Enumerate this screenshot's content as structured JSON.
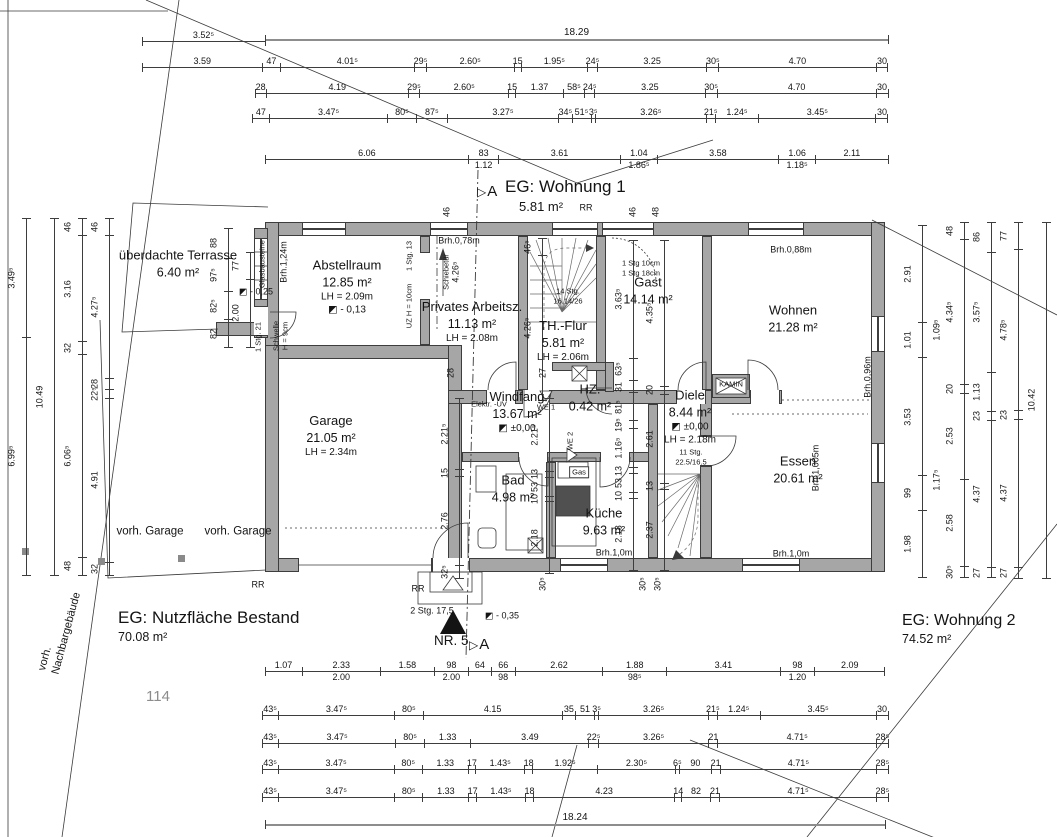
{
  "titles": {
    "wohnung1": "EG: Wohnung 1",
    "wohnung1_area": "5.81 m²",
    "wohnung2": "EG: Wohnung 2",
    "wohnung2_area": "74.52 m²",
    "bestand": "EG: Nutzfläche Bestand",
    "bestand_area": "70.08 m²",
    "parcel": "114",
    "neighbor1": "vorh.",
    "neighbor2": "Nachbargebäude",
    "house_no": "NR. 5",
    "section": "A"
  },
  "rooms": [
    {
      "name": "überdachte Terrasse",
      "lines": [
        "6.40 m²"
      ],
      "x": 178,
      "y": 264
    },
    {
      "name": "Abstellraum",
      "lines": [
        "12.85 m²",
        "LH = 2.09m",
        "◩ - 0,13"
      ],
      "x": 347,
      "y": 287
    },
    {
      "name": "Privates Arbeitsz.",
      "lines": [
        "11.13 m²",
        "LH = 2.08m"
      ],
      "x": 472,
      "y": 322
    },
    {
      "name": "TH.-Flur",
      "lines": [
        "5.81 m²",
        "LH = 2.06m"
      ],
      "x": 563,
      "y": 341
    },
    {
      "name": "Gast",
      "lines": [
        "14.14 m²"
      ],
      "x": 648,
      "y": 291
    },
    {
      "name": "Wohnen",
      "lines": [
        "21.28 m²"
      ],
      "x": 793,
      "y": 319
    },
    {
      "name": "Garage",
      "lines": [
        "21.05 m²",
        "LH = 2.34m"
      ],
      "x": 331,
      "y": 436
    },
    {
      "name": "Windfang",
      "lines": [
        "13.67 m²",
        "◩ ±0,00"
      ],
      "x": 517,
      "y": 412
    },
    {
      "name": "HZ.",
      "lines": [
        "0.42 m²"
      ],
      "x": 590,
      "y": 398
    },
    {
      "name": "Bad",
      "lines": [
        "4.98 m²"
      ],
      "x": 513,
      "y": 489
    },
    {
      "name": "Diele",
      "lines": [
        "8.44 m²",
        "◩ ±0,00",
        "LH = 2.18m"
      ],
      "x": 690,
      "y": 417
    },
    {
      "name": "Küche",
      "lines": [
        "9.63 m²"
      ],
      "x": 604,
      "y": 522
    },
    {
      "name": "Essen",
      "lines": [
        "20.61 m²"
      ],
      "x": 798,
      "y": 470
    }
  ],
  "dims": {
    "top": {
      "r1a": [
        "3.52⁵"
      ],
      "r1b": [
        "18.29"
      ],
      "r2": [
        "3.59",
        "47",
        "4.01⁵",
        "29⁵",
        "2.60⁵",
        "15",
        "1.95⁵",
        "24⁵",
        "3.25",
        "30⁵",
        "4.70",
        "30"
      ],
      "r3": [
        "28",
        "4.19",
        "29⁵",
        "2.60⁵",
        "15",
        "1.37",
        "58⁵",
        "24⁵",
        "3.25",
        "30⁵",
        "4.70",
        "30"
      ],
      "r4": [
        "47",
        "3.47⁵",
        "80⁵",
        "87⁵",
        "3.27⁵",
        "34⁵",
        "51⁵",
        "3⁵",
        "3.26⁵",
        "21⁵",
        "1.24⁵",
        "3.45⁵",
        "30"
      ],
      "r5": [
        "6.06",
        "83|1.12",
        "3.61",
        "1.04|1.86⁵",
        "3.58",
        "1.06|1.18⁵",
        "2.11"
      ]
    },
    "bottom": {
      "b1": [
        "1.07",
        "2.33|2.00",
        "1.58",
        "98|2.00",
        "64",
        "66|98",
        "2.62",
        "1.88|98⁵",
        "3.41",
        "98|1.20",
        "2.09"
      ],
      "b2": [
        "43⁵",
        "3.47⁵",
        "80⁵",
        "4.15",
        "35",
        "51",
        "3⁵",
        "3.26⁵",
        "21⁵",
        "1.24⁵",
        "3.45⁵",
        "30"
      ],
      "b3": [
        "43⁵",
        "3.47⁵",
        "80⁵",
        "1.33",
        "3.49",
        "22⁵",
        "3.26⁵",
        "21",
        "4.71⁵",
        "28⁵"
      ],
      "b4": [
        "43⁵",
        "3.47⁵",
        "80⁵",
        "1.33",
        "17",
        "1.43⁵",
        "18",
        "1.92⁵",
        "2.30⁵",
        "6⁵",
        "90",
        "21",
        "4.71⁵",
        "28⁵"
      ],
      "b5": [
        "43⁵",
        "3.47⁵",
        "80⁵",
        "1.33",
        "17",
        "1.43⁵",
        "18",
        "4.23",
        "14",
        "82",
        "21",
        "4.71⁵",
        "28⁵"
      ],
      "b6": [
        "18.24"
      ]
    },
    "left": {
      "c1": [
        "3.49⁵",
        "6.99⁵"
      ],
      "c2": [
        "10.49"
      ],
      "c3": [
        "46",
        "3.16",
        "32",
        "6.06⁵",
        "48"
      ],
      "c4": [
        "46",
        "4.27⁵",
        "28",
        "22⁵",
        "4.91",
        "32"
      ]
    },
    "right": {
      "c1": [
        "2.91",
        "1.01",
        "3.53",
        "99",
        "1.98"
      ],
      "c2": [
        "48",
        "4.34⁵",
        "20",
        "2.53",
        "2.58",
        "30⁵"
      ],
      "c3": [
        "86",
        "3.57⁵",
        "1.13",
        "23",
        "4.37",
        "27"
      ],
      "c4": [
        "77",
        "4.78⁵",
        "23",
        "4.37",
        "27"
      ],
      "c5": [
        "10.42"
      ]
    },
    "terrace": {
      "tc1": [
        "88",
        "97⁵",
        "82⁵",
        "82"
      ],
      "tc2": [
        "77",
        "2.00"
      ]
    },
    "interior": {
      "iv1": [
        "2.21⁵",
        "15",
        "2.76",
        "32⁵"
      ],
      "iv2": [
        "2.21⁵",
        "13",
        "53",
        "10",
        "2.18"
      ],
      "iv3": [
        "3.63⁵",
        "63⁵",
        "31",
        "81⁵",
        "19⁵",
        "1.16⁵",
        "13",
        "53",
        "10",
        "2.18"
      ],
      "iv4": [
        "4.35⁵",
        "20",
        "2.61",
        "13",
        "2.37"
      ],
      "iv5": [
        "46⁵",
        "4.26⁵"
      ]
    }
  },
  "labels": [
    {
      "t": "Brh.0,78m",
      "x": 459,
      "y": 241
    },
    {
      "t": "Brh.0,88m",
      "x": 791,
      "y": 250
    },
    {
      "t": "Brh.0,96m",
      "x": 868,
      "y": 377,
      "r": 1
    },
    {
      "t": "Brh.1,005m",
      "x": 816,
      "y": 468,
      "r": 1
    },
    {
      "t": "Brh.1,0m",
      "x": 614,
      "y": 553
    },
    {
      "t": "Brh.1,0m",
      "x": 791,
      "y": 554
    },
    {
      "t": "Brh.1,24m",
      "x": 284,
      "y": 262,
      "r": 1
    },
    {
      "t": "Glasbausteine",
      "x": 262,
      "y": 264,
      "r": 1,
      "c": "tiny"
    },
    {
      "t": "◩ - 0,25",
      "x": 256,
      "y": 292
    },
    {
      "t": "1 Stg. 21",
      "x": 258,
      "y": 337,
      "r": 1,
      "c": "tiny"
    },
    {
      "t": "Schwelle",
      "x": 276,
      "y": 336,
      "r": 1,
      "c": "tiny"
    },
    {
      "t": "H = 9cm",
      "x": 285,
      "y": 336,
      "r": 1,
      "c": "tiny"
    },
    {
      "t": "1 Stg. 13",
      "x": 409,
      "y": 256,
      "r": 1,
      "c": "tiny"
    },
    {
      "t": "UZ H = 10cm",
      "x": 409,
      "y": 306,
      "r": 1,
      "c": "tiny"
    },
    {
      "t": "Schiebetür",
      "x": 446,
      "y": 272,
      "r": 1,
      "c": "tiny"
    },
    {
      "t": "4.26⁵",
      "x": 456,
      "y": 272,
      "r": 1
    },
    {
      "t": "Elektr. -UV",
      "x": 489,
      "y": 404,
      "c": "tiny"
    },
    {
      "t": "WE 1",
      "x": 546,
      "y": 407,
      "c": "tiny"
    },
    {
      "t": "WE 2",
      "x": 570,
      "y": 441,
      "r": 1,
      "c": "tiny"
    },
    {
      "t": "Gas",
      "x": 579,
      "y": 472,
      "c": "tiny box"
    },
    {
      "t": "KAMIN",
      "x": 731,
      "y": 384,
      "c": "tiny"
    },
    {
      "t": "14 Stg.",
      "x": 568,
      "y": 291,
      "c": "tiny"
    },
    {
      "t": "16.14/26",
      "x": 568,
      "y": 301,
      "c": "tiny"
    },
    {
      "t": "11 Stg.",
      "x": 691,
      "y": 452,
      "c": "tiny"
    },
    {
      "t": "22.5/16.5",
      "x": 691,
      "y": 462,
      "c": "tiny"
    },
    {
      "t": "1 Stg 10cm",
      "x": 641,
      "y": 263,
      "c": "tiny"
    },
    {
      "t": "1 Stg 18cm",
      "x": 641,
      "y": 273,
      "c": "tiny"
    },
    {
      "t": "28",
      "x": 451,
      "y": 373,
      "r": 1
    },
    {
      "t": "27",
      "x": 543,
      "y": 373,
      "r": 1
    },
    {
      "t": "46",
      "x": 447,
      "y": 212,
      "r": 1
    },
    {
      "t": "46",
      "x": 633,
      "y": 212,
      "r": 1
    },
    {
      "t": "48",
      "x": 656,
      "y": 212,
      "r": 1
    },
    {
      "t": "RR",
      "x": 586,
      "y": 208
    },
    {
      "t": "RR",
      "x": 258,
      "y": 585
    },
    {
      "t": "RR",
      "x": 418,
      "y": 589
    },
    {
      "t": "2 Stg. 17,5",
      "x": 432,
      "y": 611
    },
    {
      "t": "◩ - 0,35",
      "x": 502,
      "y": 616
    },
    {
      "t": "30⁵",
      "x": 543,
      "y": 584,
      "r": 1
    },
    {
      "t": "30⁵",
      "x": 643,
      "y": 584,
      "r": 1
    },
    {
      "t": "30⁵",
      "x": 658,
      "y": 584,
      "r": 1
    },
    {
      "t": "vorh. Garage",
      "x": 150,
      "y": 532,
      "c": "m"
    },
    {
      "t": "vorh. Garage",
      "x": 238,
      "y": 532,
      "c": "m"
    },
    {
      "t": "1.09⁵",
      "x": 937,
      "y": 330,
      "r": 1
    },
    {
      "t": "1.17⁵",
      "x": 937,
      "y": 480,
      "r": 1
    }
  ]
}
